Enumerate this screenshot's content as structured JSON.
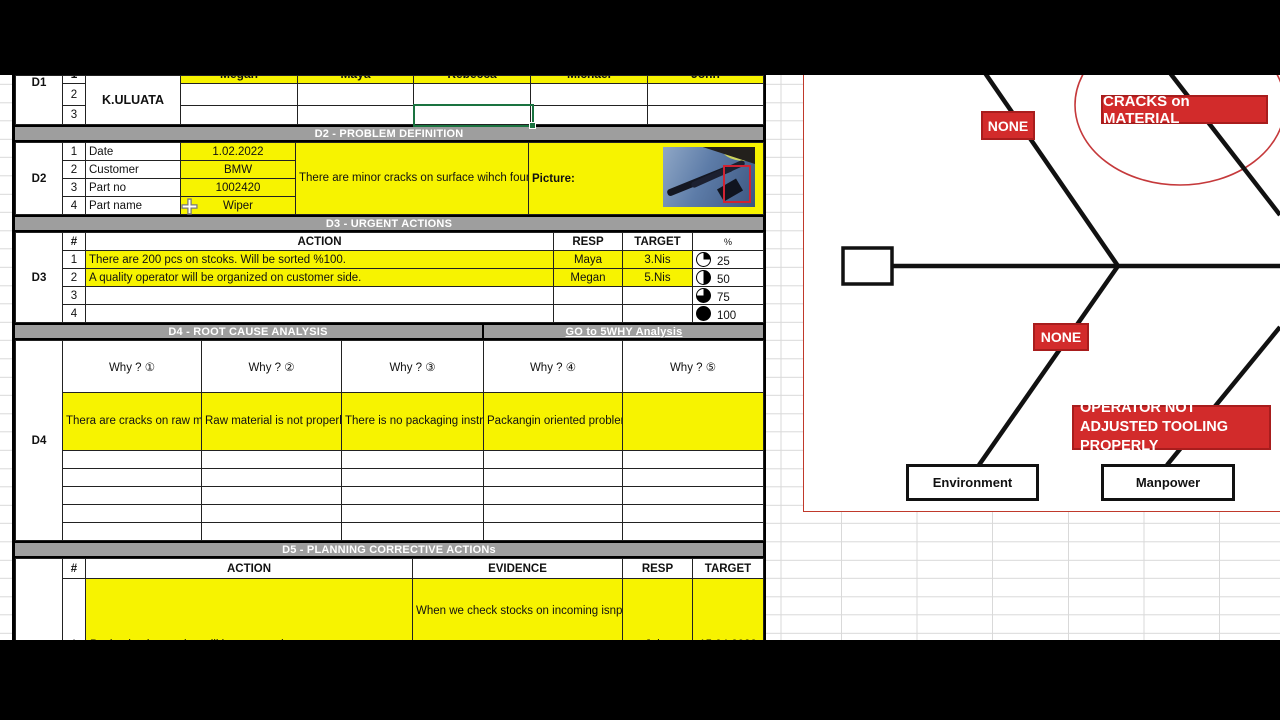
{
  "d1": {
    "label": "D1",
    "row_nums": [
      "1",
      "2",
      "3"
    ],
    "team": "K.ULUATA",
    "names": [
      "Megan",
      "Maya",
      "Rebecca",
      "Michael",
      "John"
    ]
  },
  "d2": {
    "label": "D2",
    "band": "D2 - PROBLEM DEFINITION",
    "fields": [
      {
        "num": "1",
        "name": "Date",
        "value": "1.02.2022"
      },
      {
        "num": "2",
        "name": "Customer",
        "value": "BMW"
      },
      {
        "num": "3",
        "name": "Part no",
        "value": "1002420"
      },
      {
        "num": "4",
        "name": "Part name",
        "value": "Wiper"
      }
    ],
    "description": "There are minor cracks on surface wihch found on the final inspection.",
    "picture_label": "Picture:"
  },
  "d3": {
    "label": "D3",
    "band": "D3 - URGENT ACTIONS",
    "headers": {
      "num": "#",
      "action": "ACTION",
      "resp": "RESP",
      "target": "TARGET",
      "pct": "%"
    },
    "rows": [
      {
        "num": "1",
        "action": "There are 200 pcs on stcoks. Will be sorted %100.",
        "resp": "Maya",
        "target": "3.Nis",
        "pct": "25"
      },
      {
        "num": "2",
        "action": "A quality operator will be organized on customer side.",
        "resp": "Megan",
        "target": "5.Nis",
        "pct": "50"
      },
      {
        "num": "3",
        "action": "",
        "resp": "",
        "target": "",
        "pct": "75"
      },
      {
        "num": "4",
        "action": "",
        "resp": "",
        "target": "",
        "pct": "100"
      }
    ]
  },
  "d4": {
    "label": "D4",
    "band": "D4 - ROOT CAUSE ANALYSIS",
    "band_link": "GO to 5WHY Analysis",
    "why_headers": [
      "Why ? ①",
      "Why ? ②",
      "Why ? ③",
      "Why ? ④",
      "Why ? ⑤"
    ],
    "answers": [
      "Thera are cracks on raw material.",
      "Raw material is not properly handled during production",
      "There is no packaging instruction.",
      "Packangin oriented problem is not foreseen or rsik analysis",
      ""
    ]
  },
  "d5": {
    "band": "D5 - PLANNING CORRECTIVE ACTIONs",
    "headers": {
      "num": "#",
      "action": "ACTION",
      "evidence": "EVIDENCE",
      "resp": "RESP",
      "target": "TARGET"
    },
    "rows": [
      {
        "num": "1",
        "action": "Packaging instruction will be prepared",
        "evidence": "When we check stocks on incoming isnpeciton, we did not find any cracks on raw material. But on production",
        "resp": "John",
        "target": "15.04.2022"
      }
    ]
  },
  "diagram": {
    "problem_label": "CRACKS on MATERIAL",
    "none_top": "NONE",
    "none_bottom": "NONE",
    "operator_label": "OPERATOR NOT ADJUSTED TOOLING PROPERLY",
    "categories": [
      "Environment",
      "Manpower"
    ]
  },
  "colors": {
    "cell_yellow": "#f7f300",
    "band_gray": "#9e9e9e",
    "red_label": "#d22b2b",
    "selection_green": "#1a7340",
    "diagram_border": "#c0392b"
  }
}
